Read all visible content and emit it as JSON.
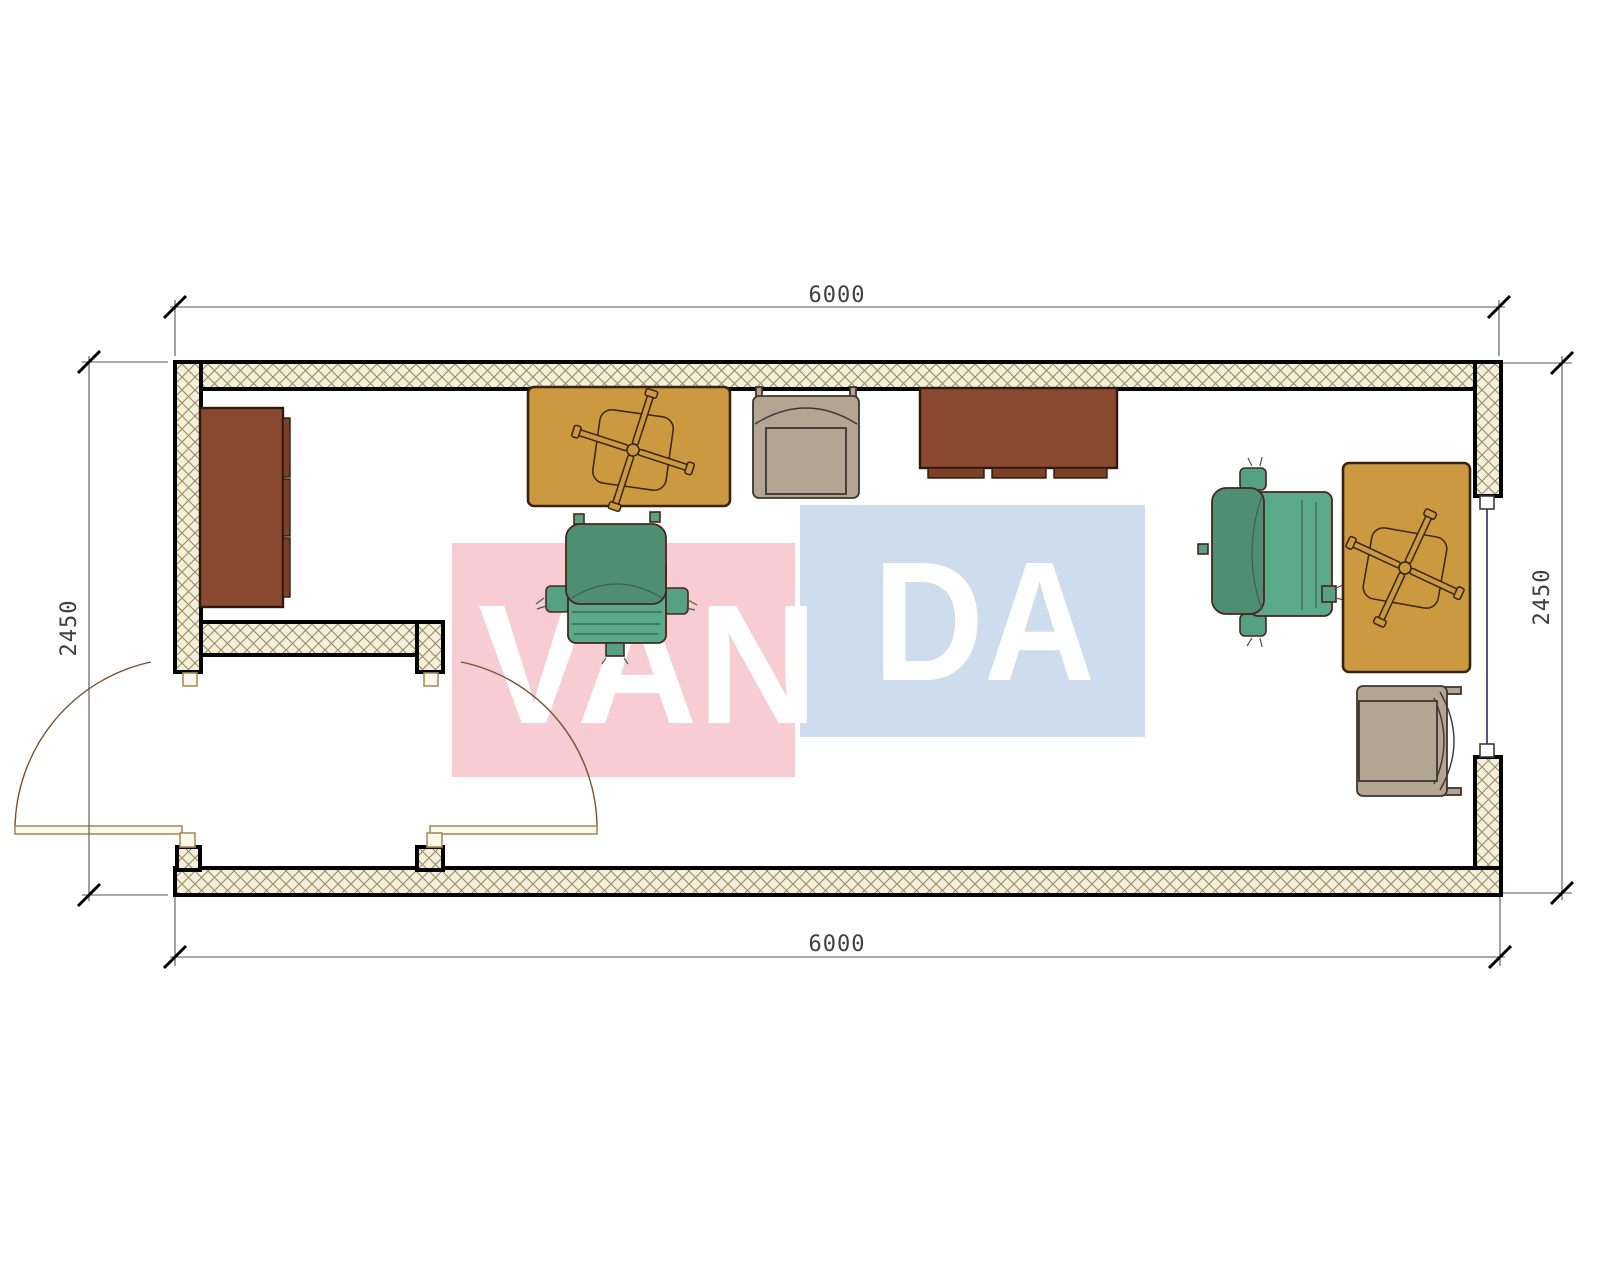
{
  "drawing_type": "container-office-floor-plan",
  "dimensions": {
    "top": "6000",
    "bottom": "6000",
    "left": "2450",
    "right": "2450"
  },
  "watermark": {
    "part1": "VAN",
    "part2": "DA",
    "pink_color": "#f8ccd3",
    "blue_color": "#cedded",
    "text_color": "#ffffff"
  },
  "colors": {
    "wall_hatch_bg": "#f4efdd",
    "wall_hatch_line": "#978c5c",
    "wall_outline": "#000000",
    "desk_fill": "#cb9a40",
    "desk_outline": "#3a230e",
    "cabinet_fill": "#8a4a31",
    "armchair_fill": "#b3a494",
    "office_chair_fill": "#55a184",
    "door_symbol": "#a3905c",
    "door_arc": "#7a5230",
    "window_glazing": "#2b2b66",
    "dimension_line": "#555555",
    "dimension_text": "#3f3f3f"
  },
  "furniture_icons": [
    "cabinet-icon",
    "desk-with-swivel-chair-icon",
    "armchair-icon",
    "tv-stand-icon",
    "office-chair-icon",
    "office-chair-icon",
    "desk-with-swivel-chair-icon",
    "armchair-icon"
  ]
}
